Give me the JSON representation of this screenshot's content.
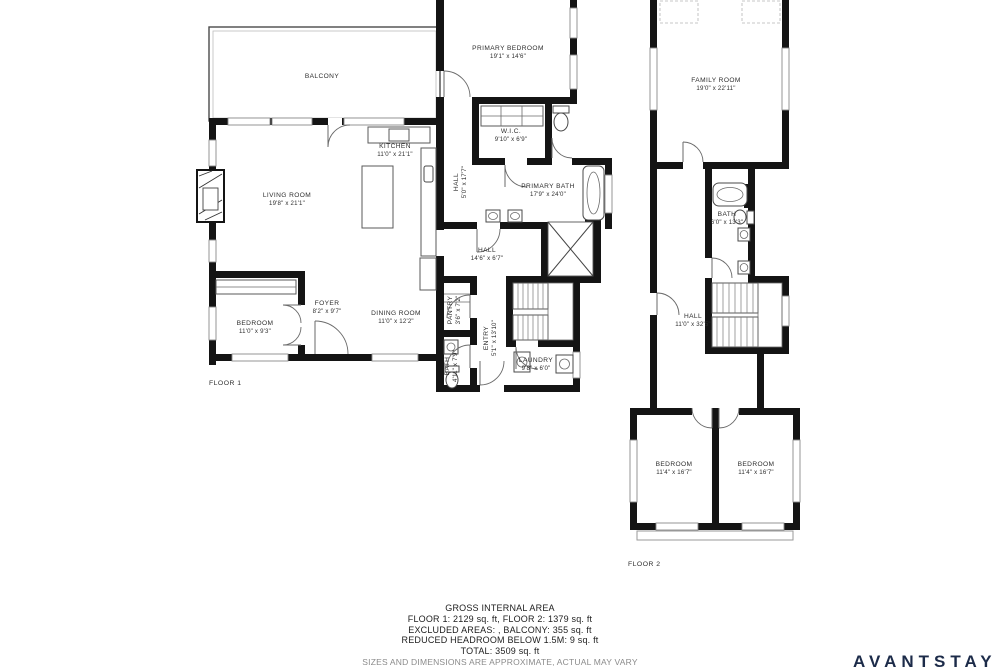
{
  "brand": {
    "logo_text": "AVANTSTAY",
    "color": "#1c2b49"
  },
  "summary": {
    "title": "GROSS INTERNAL AREA",
    "line1": "FLOOR 1: 2129 sq. ft, FLOOR 2: 1379 sq. ft",
    "line2": "EXCLUDED AREAS: , BALCONY: 355 sq. ft",
    "line3": "REDUCED HEADROOM BELOW 1.5M: 9 sq. ft",
    "line4": "TOTAL: 3509 sq. ft",
    "disclaimer": "SIZES AND DIMENSIONS ARE APPROXIMATE, ACTUAL MAY VARY"
  },
  "floor1": {
    "label": "FLOOR 1",
    "rooms": {
      "balcony": {
        "name": "BALCONY",
        "dims": ""
      },
      "living_room": {
        "name": "LIVING ROOM",
        "dims": "19'8\" x 21'1\""
      },
      "kitchen": {
        "name": "KITCHEN",
        "dims": "11'0\" x 21'1\""
      },
      "primary_bedroom": {
        "name": "PRIMARY BEDROOM",
        "dims": "19'1\" x 14'6\""
      },
      "wic": {
        "name": "W.I.C.",
        "dims": "9'10\" x 6'9\""
      },
      "primary_bath": {
        "name": "PRIMARY BATH",
        "dims": "17'9\" x 24'0\""
      },
      "hall_upper": {
        "name": "HALL",
        "dims": "5'0\" x 17'7\""
      },
      "hall": {
        "name": "HALL",
        "dims": "14'6\" x 6'7\""
      },
      "pantry": {
        "name": "PANTRY",
        "dims": "3'6\" x 7'2\""
      },
      "entry": {
        "name": "ENTRY",
        "dims": "5'1\" x 13'10\""
      },
      "bath": {
        "name": "BATH",
        "dims": "4'11\" x 7'9\""
      },
      "laundry": {
        "name": "LAUNDRY",
        "dims": "9'8\" x 6'0\""
      },
      "foyer": {
        "name": "FOYER",
        "dims": "8'2\" x 9'7\""
      },
      "dining_room": {
        "name": "DINING ROOM",
        "dims": "11'0\" x 12'2\""
      },
      "bedroom": {
        "name": "BEDROOM",
        "dims": "11'0\" x 9'3\""
      }
    }
  },
  "floor2": {
    "label": "FLOOR 2",
    "rooms": {
      "family_room": {
        "name": "FAMILY ROOM",
        "dims": "19'0\" x 22'11\""
      },
      "bath": {
        "name": "BATH",
        "dims": "6'0\" x 13'3\""
      },
      "hall": {
        "name": "HALL",
        "dims": "11'0\" x 32'5\""
      },
      "bedroom_left": {
        "name": "BEDROOM",
        "dims": "11'4\" x 16'7\""
      },
      "bedroom_right": {
        "name": "BEDROOM",
        "dims": "11'4\" x 16'7\""
      }
    }
  }
}
